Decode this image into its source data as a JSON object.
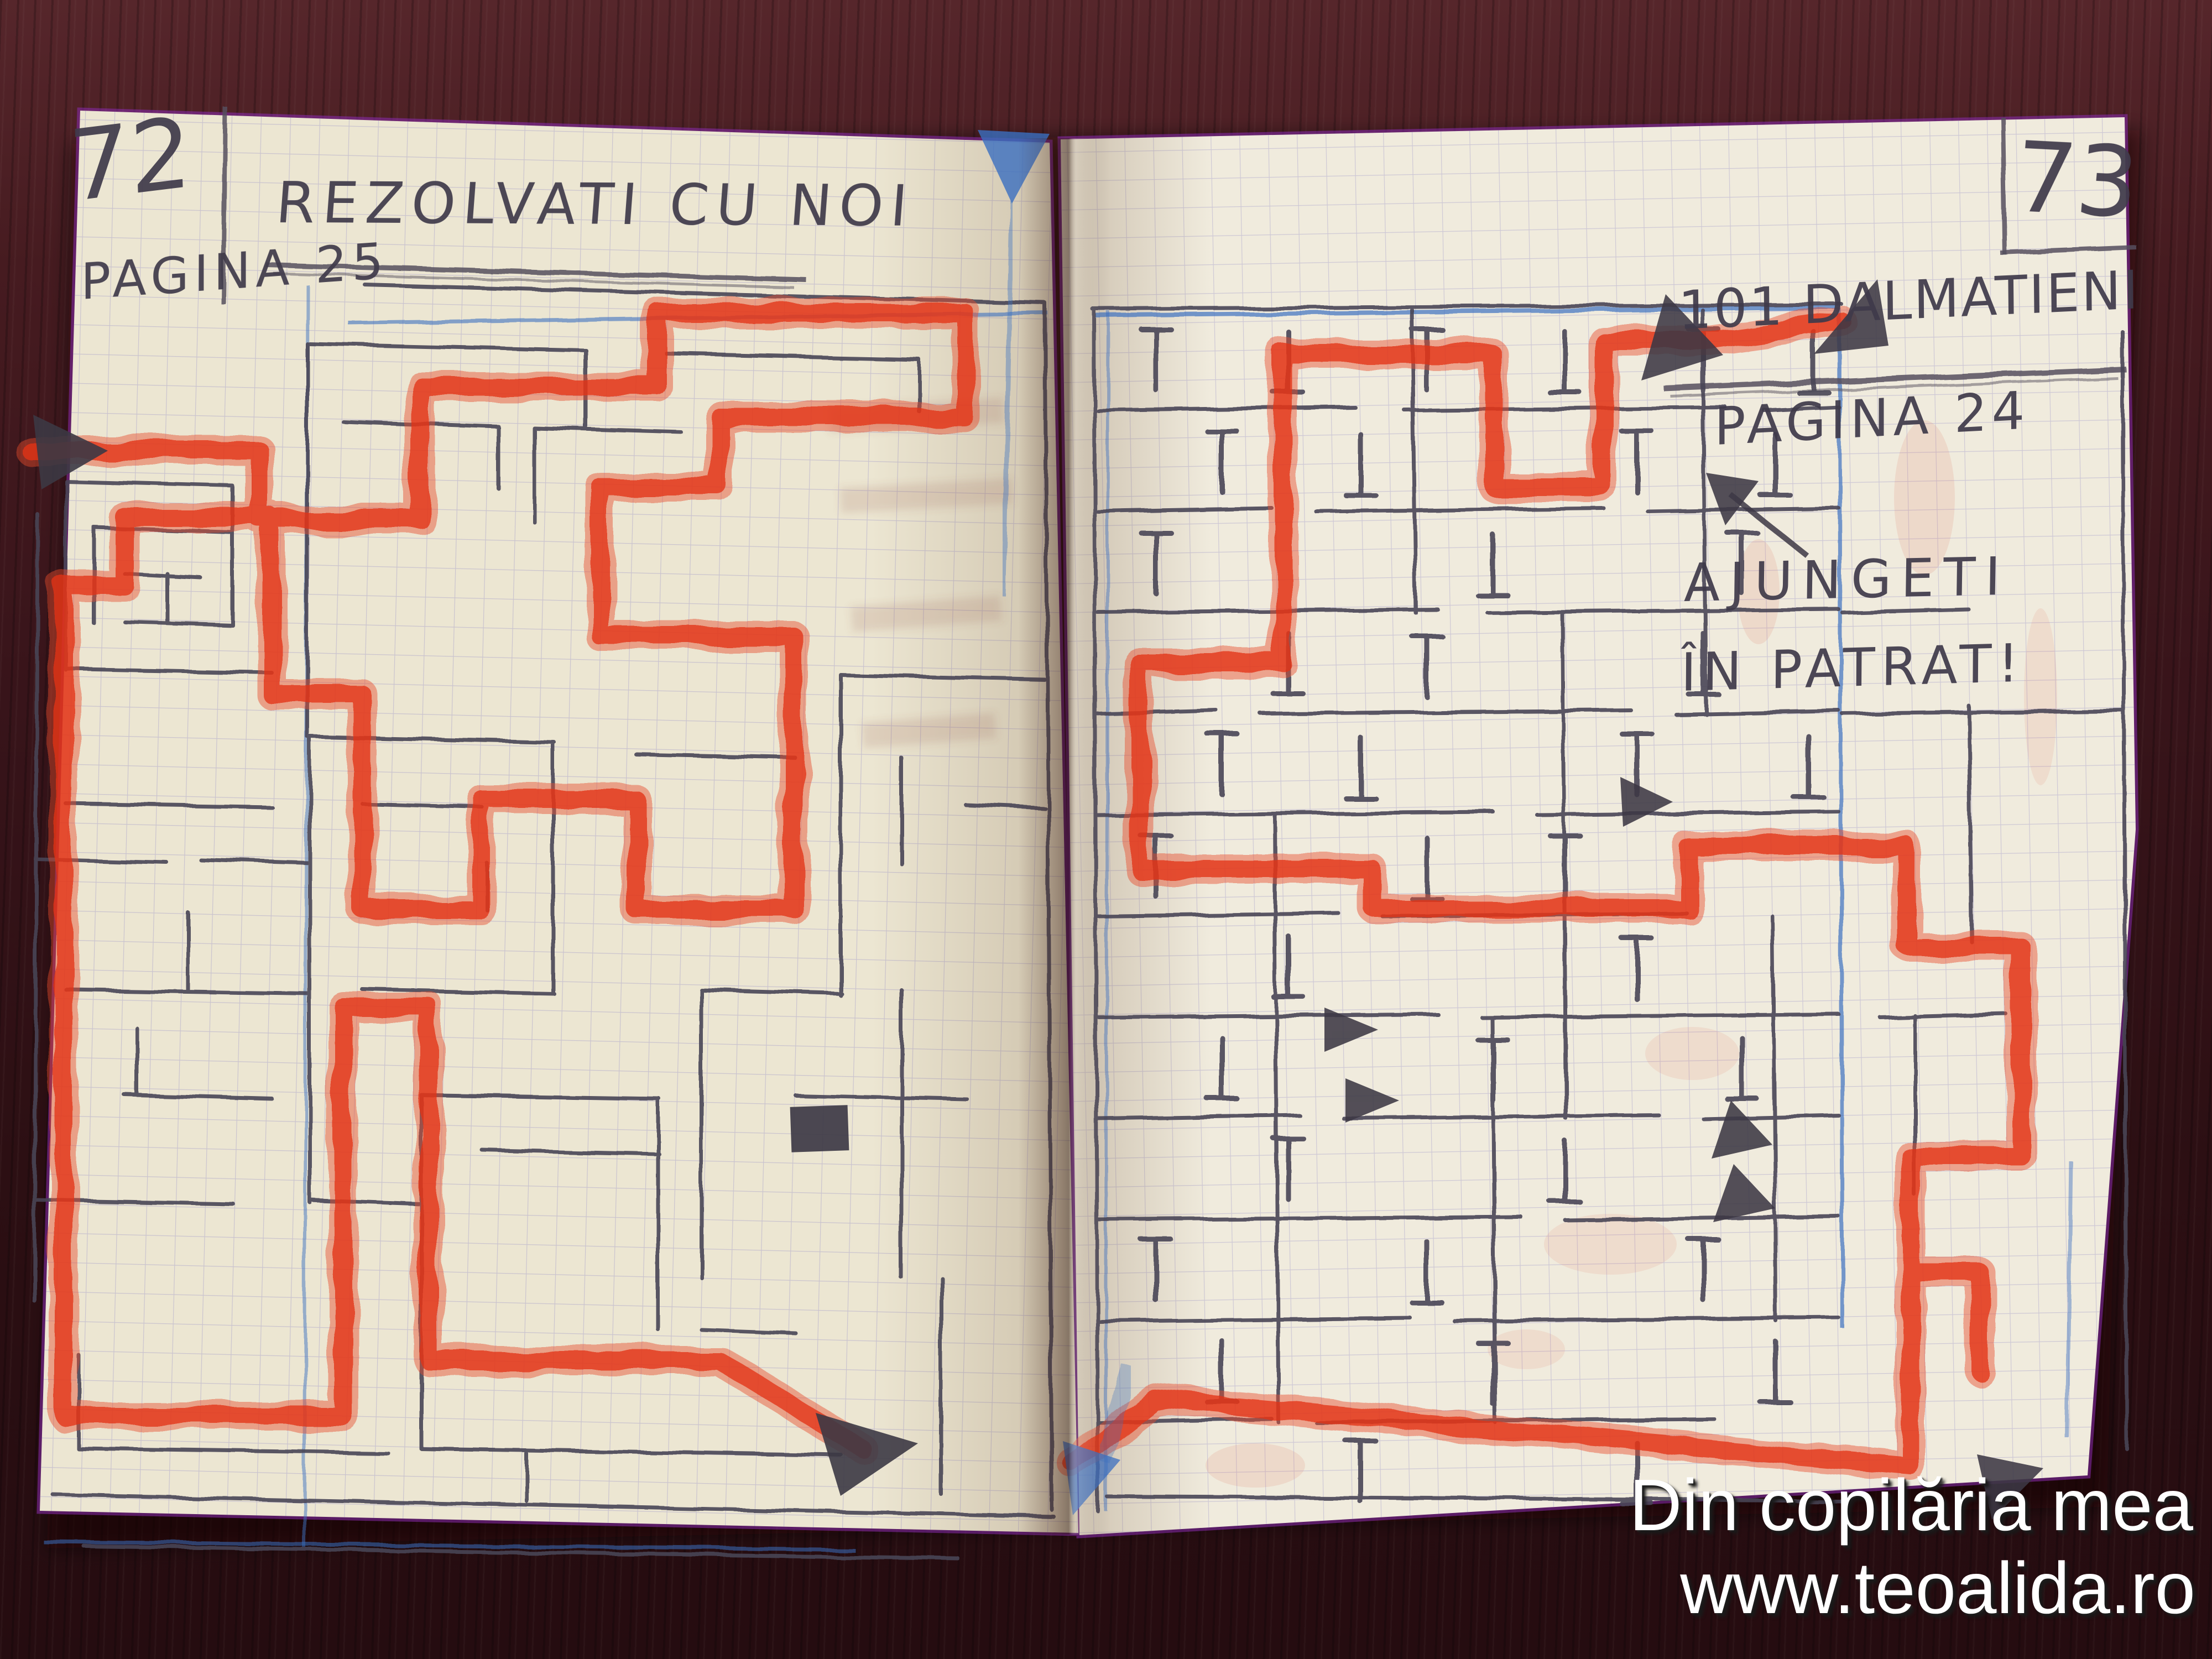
{
  "left_page": {
    "page_number": "72",
    "title": "REZOLVATI CU NOI",
    "subtitle": "PAGINA 25"
  },
  "right_page": {
    "page_number": "73",
    "title": "101 DALMATIENI",
    "subtitle": "PAGINA 24",
    "note_line1": "AJUNGETI",
    "note_line2": "ÎN PATRAT!"
  },
  "watermark": {
    "line1": "Din copilăria mea",
    "line2": "www.teoalida.ro"
  },
  "colors": {
    "path_red": "#e64a2e",
    "path_red_core": "#e23318",
    "pencil": "#4a4456",
    "margin_blue": "#3b6fc0",
    "grid_blue": "#9b93c9",
    "paper_left": "#ece6d2",
    "paper_right": "#f0ebdd",
    "wood": "#38141a",
    "edge_fringe": "#8a2bb0",
    "arrow_dark": "#3c3844",
    "watermark_white": "#ffffff"
  }
}
